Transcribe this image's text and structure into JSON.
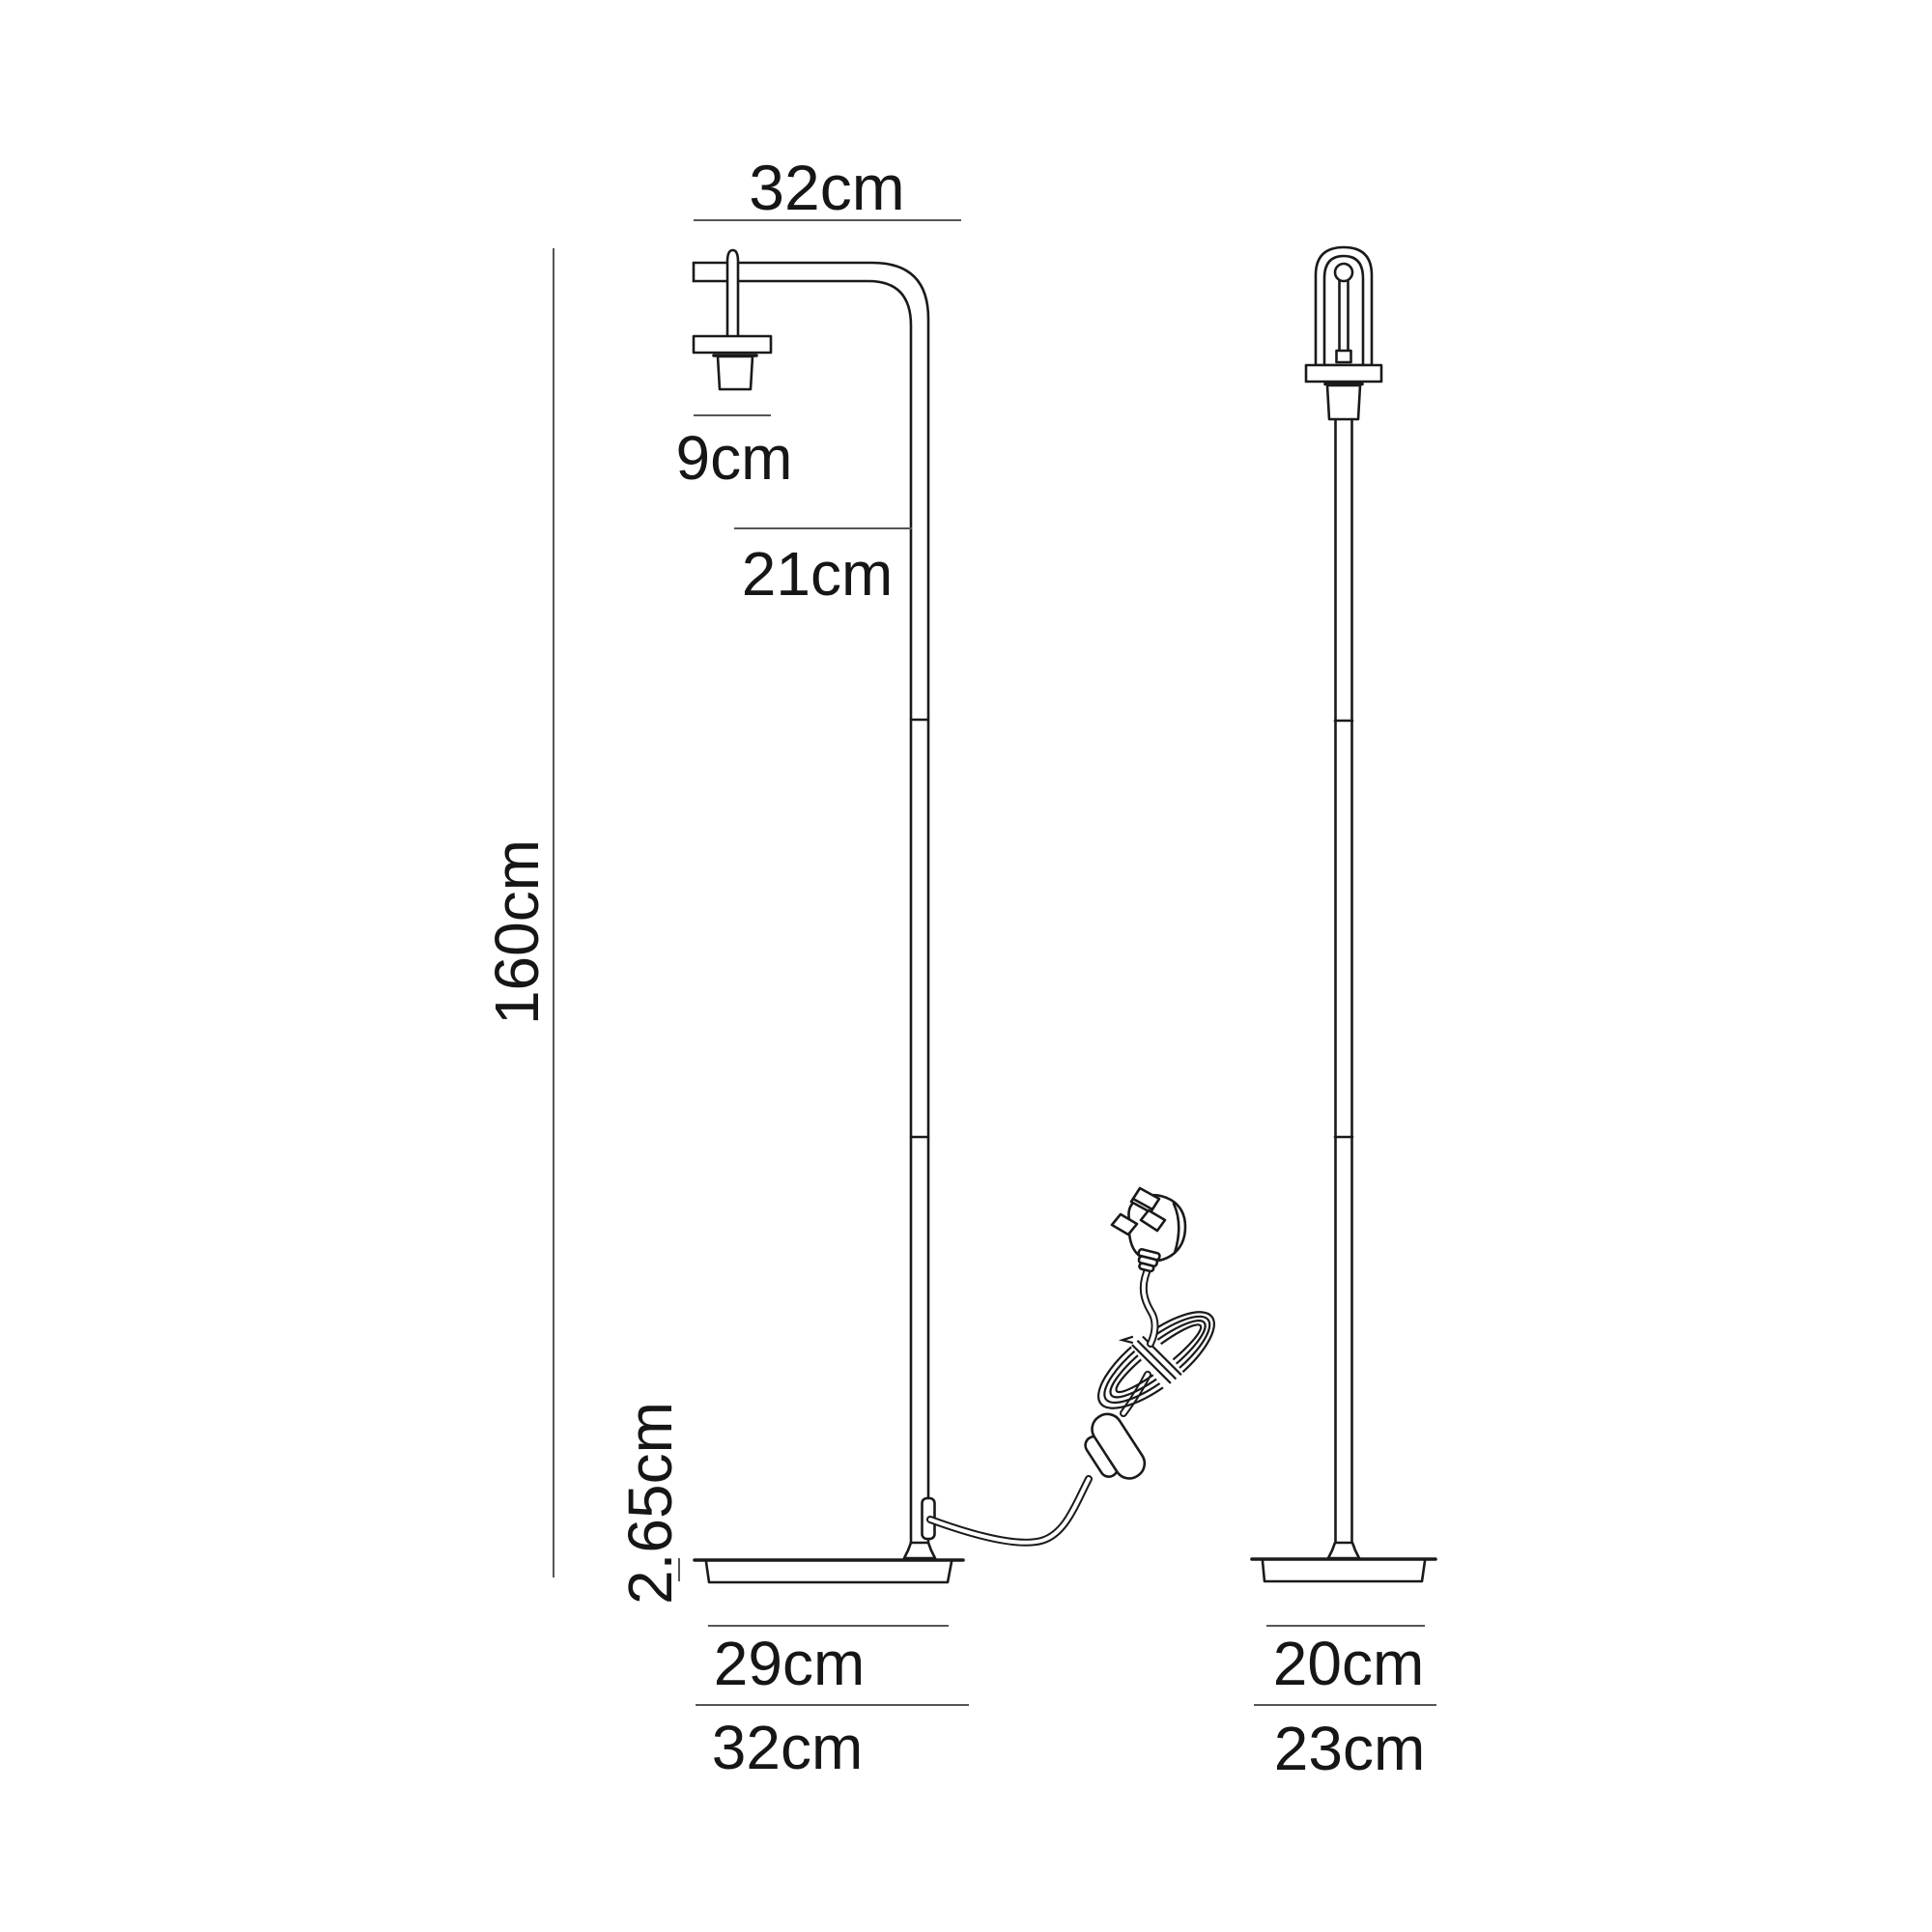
{
  "drawing": {
    "type": "floor-lamp-dimension-diagram",
    "views": [
      "front",
      "side"
    ]
  },
  "dimensions": {
    "top_width": "32cm",
    "height": "160cm",
    "socket_width": "9cm",
    "arm_offset": "21cm",
    "base_thickness": "2.65cm",
    "base_inner_width": "29cm",
    "base_outer_width": "32cm",
    "base_inner_depth": "20cm",
    "base_outer_depth": "23cm"
  },
  "colors": {
    "ink": "#1a1a1a",
    "dimension_line": "#555555",
    "background": "#ffffff"
  }
}
